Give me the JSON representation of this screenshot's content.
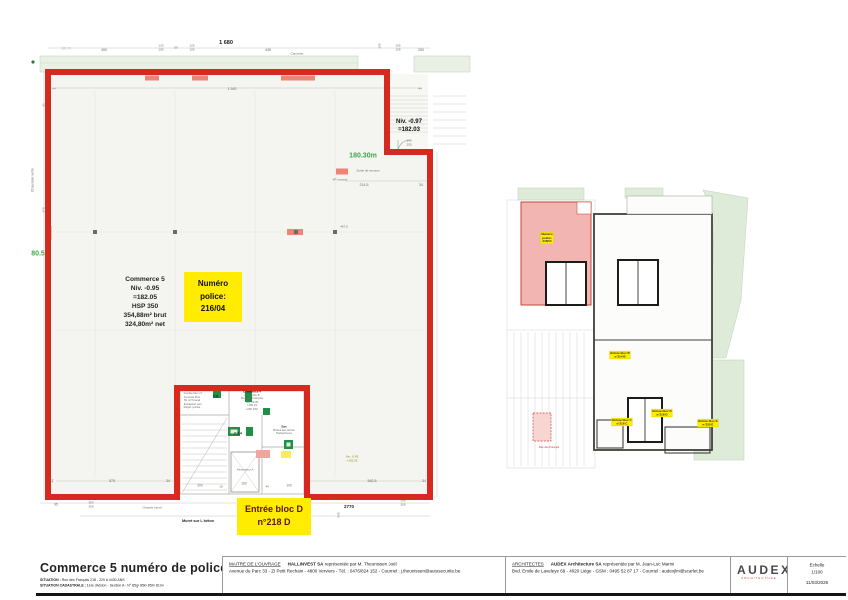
{
  "colors": {
    "outline_red": "#d42a20",
    "highlight_yellow": "#ffec00",
    "boundary_green": "#3aaa4e",
    "commerce_pink": "#f3b5b1"
  },
  "main_plan": {
    "commerce_info": "Commerce 5\nNiv. -0.95\n=182.05\nHSP 350\n354,88m² brut\n324,80m² net",
    "police_box": "Numéro\npolice:\n216/04",
    "entree_box": "Entrée bloc D\nn°218 D",
    "niv_097": "Niv. -0.97\n=182.03"
  },
  "annotations": [
    {
      "t": "1 680",
      "x": 226,
      "y": 43,
      "s": 5.5,
      "c": "k",
      "b": 1
    },
    {
      "t": "400",
      "x": 104,
      "y": 50,
      "s": 3.6
    },
    {
      "t": "125",
      "x": 161,
      "y": 46,
      "s": 3
    },
    {
      "t": "105",
      "x": 161,
      "y": 50,
      "s": 3
    },
    {
      "t": "50",
      "x": 176,
      "y": 48,
      "s": 3
    },
    {
      "t": "125",
      "x": 192,
      "y": 46,
      "s": 3
    },
    {
      "t": "105",
      "x": 192,
      "y": 50,
      "s": 3
    },
    {
      "t": "445",
      "x": 268,
      "y": 50,
      "s": 3.6
    },
    {
      "t": "Caniveau",
      "x": 297,
      "y": 54,
      "s": 3
    },
    {
      "t": "205",
      "x": 380,
      "y": 46,
      "s": 3,
      "r": -90
    },
    {
      "t": "105",
      "x": 398,
      "y": 46,
      "s": 3
    },
    {
      "t": "105",
      "x": 398,
      "y": 50,
      "s": 3
    },
    {
      "t": "250",
      "x": 421,
      "y": 50,
      "s": 3.6
    },
    {
      "t": "180.70",
      "x": 66,
      "y": 49,
      "s": 3.2,
      "c": "lg"
    },
    {
      "t": "1 592",
      "x": 232,
      "y": 89,
      "s": 3.6
    },
    {
      "t": "44",
      "x": 54,
      "y": 89,
      "s": 3
    },
    {
      "t": "44",
      "x": 420,
      "y": 89,
      "s": 3
    },
    {
      "t": "140",
      "x": 409,
      "y": 141,
      "s": 3
    },
    {
      "t": "205",
      "x": 409,
      "y": 145,
      "s": 3
    },
    {
      "t": "180.30m",
      "x": 363,
      "y": 155,
      "s": 7,
      "c": "g",
      "b": 1
    },
    {
      "t": "Sortie de secours",
      "x": 368,
      "y": 171,
      "s": 3
    },
    {
      "t": "4P ouvrant",
      "x": 340,
      "y": 180,
      "s": 3
    },
    {
      "t": "214,5",
      "x": 364,
      "y": 185,
      "s": 3.6
    },
    {
      "t": "34",
      "x": 421,
      "y": 185,
      "s": 3.6
    },
    {
      "t": "80.5",
      "x": 38,
      "y": 253,
      "s": 7,
      "c": "g",
      "b": 1
    },
    {
      "t": "Chaussée verte",
      "x": 33,
      "y": 180,
      "s": 3.4,
      "r": -90
    },
    {
      "t": "470",
      "x": 44,
      "y": 210,
      "s": 3,
      "r": -90
    },
    {
      "t": "92",
      "x": 44,
      "y": 105,
      "s": 3,
      "r": -90
    },
    {
      "t": "467,5",
      "x": 344,
      "y": 227,
      "s": 3
    },
    {
      "t": "44",
      "x": 53,
      "y": 481,
      "s": 3,
      "r": -90
    },
    {
      "t": "575",
      "x": 112,
      "y": 481,
      "s": 3.6
    },
    {
      "t": "34",
      "x": 168,
      "y": 481,
      "s": 3.6
    },
    {
      "t": "200",
      "x": 200,
      "y": 486,
      "s": 3.2
    },
    {
      "t": "19",
      "x": 221,
      "y": 487,
      "s": 3
    },
    {
      "t": "160",
      "x": 244,
      "y": 484,
      "s": 3.2
    },
    {
      "t": "44",
      "x": 267,
      "y": 487,
      "s": 3
    },
    {
      "t": "100",
      "x": 289,
      "y": 486,
      "s": 3.2
    },
    {
      "t": "582,5",
      "x": 372,
      "y": 481,
      "s": 3.6
    },
    {
      "t": "34",
      "x": 424,
      "y": 481,
      "s": 3.6
    },
    {
      "t": "Niv. -0.95",
      "x": 352,
      "y": 457,
      "s": 3,
      "c": "o"
    },
    {
      "t": "=182.05",
      "x": 352,
      "y": 461,
      "s": 3,
      "c": "o"
    },
    {
      "t": "95",
      "x": 56,
      "y": 505,
      "s": 3.2
    },
    {
      "t": "363",
      "x": 91,
      "y": 503,
      "s": 3
    },
    {
      "t": "300",
      "x": 91,
      "y": 507,
      "s": 3
    },
    {
      "t": "Chassis mural",
      "x": 152,
      "y": 508,
      "s": 3
    },
    {
      "t": "478",
      "x": 253,
      "y": 506,
      "s": 3.2
    },
    {
      "t": "223,2",
      "x": 334,
      "y": 499,
      "s": 3
    },
    {
      "t": "2770",
      "x": 349,
      "y": 507,
      "s": 4.5,
      "c": "k",
      "b": 1
    },
    {
      "t": "540",
      "x": 339,
      "y": 515,
      "s": 3,
      "r": -90
    },
    {
      "t": "240",
      "x": 403,
      "y": 501,
      "s": 3
    },
    {
      "t": "200",
      "x": 403,
      "y": 505,
      "s": 3
    },
    {
      "t": "Muret sur L béton",
      "x": 198,
      "y": 521,
      "s": 3.8,
      "c": "k",
      "b": 1
    },
    {
      "t": "Double Flux x7",
      "x": 193,
      "y": 394,
      "s": 2.8
    },
    {
      "t": "Amenée libre",
      "x": 192,
      "y": 397.5,
      "s": 2.8
    },
    {
      "t": "50 m³/h local",
      "x": 192,
      "y": 401,
      "s": 2.8
    },
    {
      "t": "Extraction san.",
      "x": 193,
      "y": 404.5,
      "s": 2.8
    },
    {
      "t": "Régul. portes",
      "x": 192,
      "y": 408,
      "s": 2.8
    },
    {
      "t": "C.6.",
      "x": 216,
      "y": 397,
      "s": 3.2,
      "c": "k",
      "b": 1
    },
    {
      "t": "C.6.4",
      "x": 238,
      "y": 434,
      "s": 3.2,
      "c": "k",
      "b": 1
    },
    {
      "t": "Commerce 4",
      "x": 252,
      "y": 392,
      "s": 3,
      "c": "k",
      "b": 1
    },
    {
      "t": "Immeuble B",
      "x": 252,
      "y": 395.5,
      "s": 2.8
    },
    {
      "t": "Rue des Français",
      "x": 252,
      "y": 399,
      "s": 2.8
    },
    {
      "t": "Niv. ±0.00",
      "x": 252,
      "y": 402.5,
      "s": 2.8
    },
    {
      "t": "=182.15",
      "x": 252,
      "y": 406,
      "s": 2.8
    },
    {
      "t": "HSP 260",
      "x": 252,
      "y": 409.5,
      "s": 2.8
    },
    {
      "t": "Sas",
      "x": 284,
      "y": 427,
      "s": 3,
      "c": "k",
      "b": 1
    },
    {
      "t": "Boîtes aux lettres",
      "x": 284,
      "y": 430.5,
      "s": 2.8
    },
    {
      "t": "Parlophones",
      "x": 284,
      "y": 434,
      "s": 2.8
    },
    {
      "t": "Ascenseur A",
      "x": 245,
      "y": 470,
      "s": 3
    },
    {
      "t": "Rue des Français",
      "x": 549,
      "y": 448,
      "s": 2.6,
      "c": "r"
    }
  ],
  "mini_plan": {
    "yellow_labels": [
      {
        "x": 547,
        "y": 238,
        "lines": [
          "Numéro",
          "police:",
          "216/04"
        ]
      },
      {
        "x": 620,
        "y": 355,
        "lines": [
          "Entrée bloc B",
          "n°214 B"
        ]
      },
      {
        "x": 622,
        "y": 422,
        "lines": [
          "Entrée bloc C",
          "n°216 C"
        ]
      },
      {
        "x": 662,
        "y": 413,
        "lines": [
          "Entrée bloc D",
          "n°218 D"
        ]
      },
      {
        "x": 708,
        "y": 423,
        "lines": [
          "Entrée bloc E",
          "n°220 E"
        ]
      }
    ]
  },
  "titleblock": {
    "title": "Commerce 5 numéro de police 216/04",
    "situation_label": "SITUATION :",
    "situation_value": "Rue des Français 218 - 220 à 4430 ANS",
    "cadastrale_label": "SITUATION CADASTRALE :",
    "cadastrale_value": "1ère division - Section A - N° 85g² 85k² 85h² 81m²",
    "maitre": {
      "label": "MAITRE DE L'OUVRAGE",
      "name": "HALLINVEST SA",
      "rep": " représentée par M. Theunissen Joël",
      "address": "Avenue du Parc 33 - ZI Petit Rechain - 4800 Verviers - Tél. : 0476/824 152 - Courriel : j.theunissen@autosecurite.be"
    },
    "architectes": {
      "label": "ARCHITECTES",
      "name": "AUDEX Architecture SA",
      "rep": " représentée par M. Jean-Luc Marini",
      "address": "Bvd. Emile de Laveleye 69 - 4020 Liège - GSM : 0495 52 87 17 - Courriel : audexjlm@scarlet.be"
    },
    "logo": {
      "text": "AUDEX",
      "sub": "ARCHITECTURE"
    },
    "echelle": {
      "label": "Echelle",
      "value": "1/100",
      "date": "11/03/2026"
    }
  }
}
